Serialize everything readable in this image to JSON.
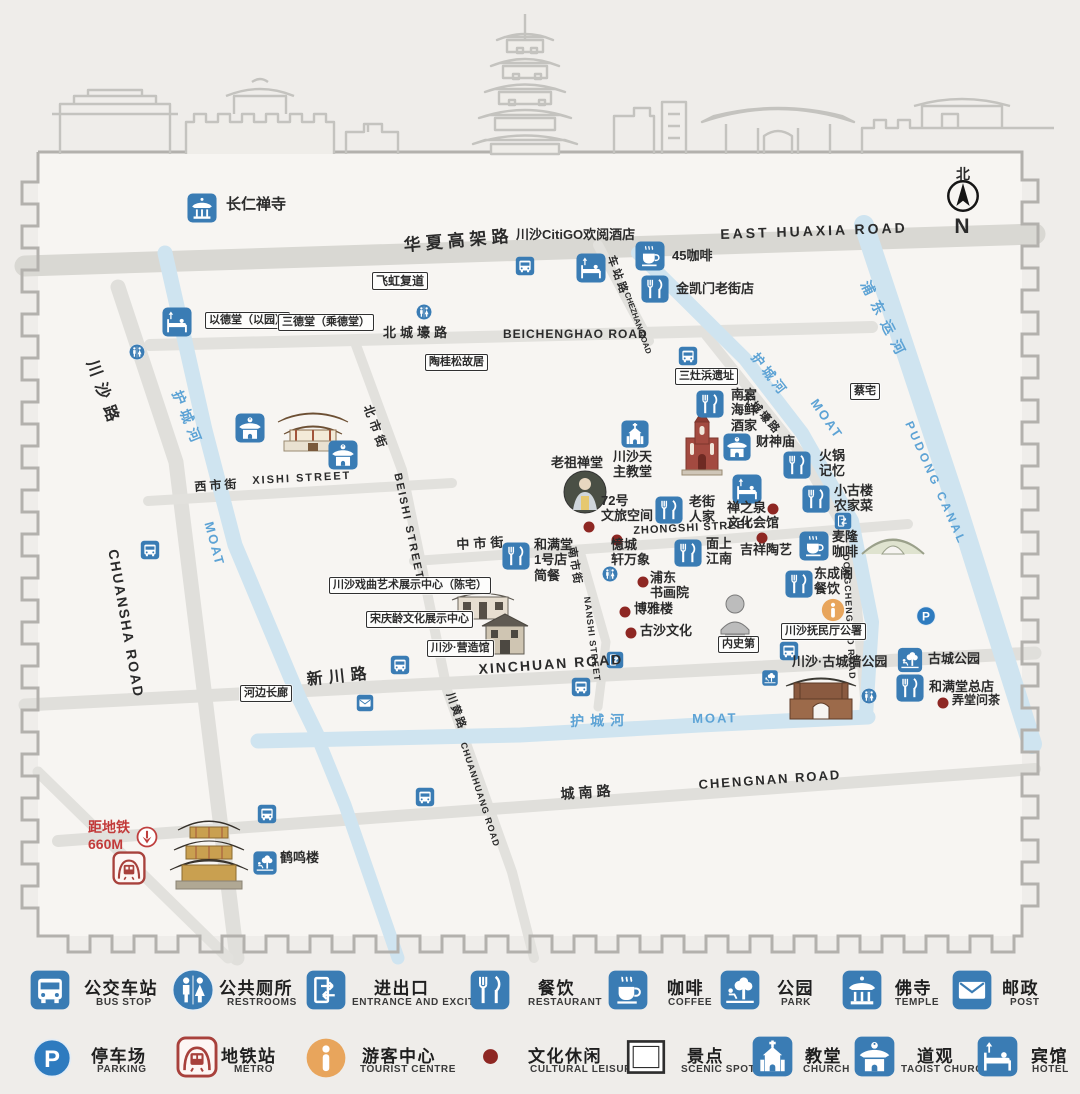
{
  "title": "川沙古镇导览图 Chuansha Old Town tourist map",
  "colors": {
    "icon_blue": "#3a7cb4",
    "metro_red": "#a8413c",
    "tourist_orange": "#e8a55c",
    "river_blue": "#cfe4f0",
    "river_text": "#5da3d5",
    "leisure_dot": "#8e2723",
    "red_text": "#c23a3a",
    "road_gray": "#e2e1dd",
    "ink": "#2b2b2b"
  },
  "north": {
    "zh": "北",
    "en": "N"
  },
  "map": {
    "labels": [
      {
        "t": "华夏高架路",
        "x": 403,
        "y": 236,
        "s": 17,
        "r": -5,
        "k": 5
      },
      {
        "t": "EAST HUAXIA ROAD",
        "x": 720,
        "y": 226,
        "s": 14,
        "r": -2,
        "k": 3
      },
      {
        "t": "北城壕路",
        "x": 383,
        "y": 325,
        "s": 13,
        "k": 4
      },
      {
        "t": "BEICHENGHAO ROAD",
        "x": 503,
        "y": 327,
        "s": 12,
        "k": 1
      },
      {
        "t": "车站路",
        "x": 616,
        "y": 254,
        "s": 11,
        "r": 70,
        "k": 3
      },
      {
        "t": "CHEZHAN ROAD",
        "x": 631,
        "y": 291,
        "s": 8,
        "r": 70
      },
      {
        "t": "川沙路",
        "x": 99,
        "y": 358,
        "s": 16,
        "r": 70,
        "k": 8
      },
      {
        "t": "CHUANSHA ROAD",
        "x": 121,
        "y": 548,
        "s": 14,
        "r": 80,
        "k": 2
      },
      {
        "t": "护城河",
        "x": 184,
        "y": 388,
        "s": 14,
        "r": 68,
        "c": "river",
        "k": 6
      },
      {
        "t": "MOAT",
        "x": 216,
        "y": 520,
        "s": 13,
        "r": 75,
        "c": "river",
        "k": 2
      },
      {
        "t": "西市街",
        "x": 194,
        "y": 480,
        "s": 12,
        "r": -4,
        "k": 3
      },
      {
        "t": "XISHI STREET",
        "x": 252,
        "y": 475,
        "s": 11,
        "r": -3,
        "k": 2
      },
      {
        "t": "北市街",
        "x": 374,
        "y": 403,
        "s": 12,
        "r": 70,
        "k": 4
      },
      {
        "t": "BEISHI STREET",
        "x": 403,
        "y": 472,
        "s": 11,
        "r": 78,
        "k": 2
      },
      {
        "t": "中市街",
        "x": 456,
        "y": 537,
        "s": 13,
        "r": -3,
        "k": 4
      },
      {
        "t": "ZHONGSHI STREET",
        "x": 633,
        "y": 525,
        "s": 11,
        "r": -3,
        "k": 1
      },
      {
        "t": "南市街",
        "x": 577,
        "y": 546,
        "s": 11,
        "r": 80,
        "k": 2
      },
      {
        "t": "NANSHI STREET",
        "x": 592,
        "y": 596,
        "s": 9,
        "r": 83,
        "k": 1
      },
      {
        "t": "东城壕路",
        "x": 748,
        "y": 390,
        "s": 11,
        "r": 48,
        "k": 2
      },
      {
        "t": "DONGCHENGHAO ROAD",
        "x": 851,
        "y": 554,
        "s": 9,
        "r": 87,
        "k": 1
      },
      {
        "t": "新川路",
        "x": 306,
        "y": 672,
        "s": 16,
        "r": -6,
        "k": 6
      },
      {
        "t": "XINCHUAN ROAD",
        "x": 478,
        "y": 661,
        "s": 14,
        "r": -4,
        "k": 2
      },
      {
        "t": "川黄路",
        "x": 455,
        "y": 691,
        "s": 11,
        "r": 70,
        "k": 2
      },
      {
        "t": "CHUANHUANG ROAD",
        "x": 468,
        "y": 741,
        "s": 9,
        "r": 72,
        "k": 1
      },
      {
        "t": "护城河",
        "x": 570,
        "y": 713,
        "s": 14,
        "r": -1,
        "c": "river",
        "k": 6
      },
      {
        "t": "MOAT",
        "x": 692,
        "y": 711,
        "s": 13,
        "r": -1,
        "c": "river",
        "k": 2
      },
      {
        "t": "城南路",
        "x": 560,
        "y": 786,
        "s": 14,
        "r": -4,
        "k": 4
      },
      {
        "t": "CHENGNAN ROAD",
        "x": 698,
        "y": 777,
        "s": 13,
        "r": -4,
        "k": 2
      },
      {
        "t": "浦东运河",
        "x": 872,
        "y": 278,
        "s": 14,
        "r": 63,
        "c": "river",
        "k": 8
      },
      {
        "t": "PUDONG CANAL",
        "x": 915,
        "y": 419,
        "s": 12,
        "r": 66,
        "c": "river",
        "k": 3
      },
      {
        "t": "护城河",
        "x": 760,
        "y": 350,
        "s": 13,
        "r": 52,
        "c": "river",
        "k": 4
      },
      {
        "t": "MOAT",
        "x": 820,
        "y": 396,
        "s": 13,
        "r": 55,
        "c": "river",
        "k": 2
      },
      {
        "t": "长仁禅寺",
        "x": 226,
        "y": 196,
        "s": 15
      },
      {
        "t": "川沙CitiGO欢阅酒店",
        "x": 516,
        "y": 227,
        "s": 13
      },
      {
        "t": "45咖啡",
        "x": 672,
        "y": 248,
        "s": 13
      },
      {
        "t": "金凯门老街店",
        "x": 676,
        "y": 281,
        "s": 13
      },
      {
        "t": "飞虹复道",
        "x": 372,
        "y": 272,
        "s": 12,
        "b": true
      },
      {
        "t": "以德堂（以园）",
        "x": 205,
        "y": 312,
        "s": 11,
        "b": true
      },
      {
        "t": "三德堂（乘德堂）",
        "x": 278,
        "y": 314,
        "s": 11,
        "b": true
      },
      {
        "t": "陶桂松故居",
        "x": 425,
        "y": 354,
        "s": 11,
        "b": true
      },
      {
        "t": "三灶浜遗址",
        "x": 675,
        "y": 368,
        "s": 11,
        "b": true
      },
      {
        "t": "蔡宅",
        "x": 850,
        "y": 383,
        "s": 11,
        "b": true
      },
      {
        "t": "南宫\n海鲜\n酒家",
        "x": 731,
        "y": 387,
        "s": 13
      },
      {
        "t": "财神庙",
        "x": 756,
        "y": 434,
        "s": 13
      },
      {
        "t": "川沙天\n主教堂",
        "x": 613,
        "y": 449,
        "s": 13
      },
      {
        "t": "老祖禅堂",
        "x": 551,
        "y": 455,
        "s": 13
      },
      {
        "t": "72号\n文旅空间",
        "x": 601,
        "y": 493,
        "s": 13
      },
      {
        "t": "老街\n人家",
        "x": 689,
        "y": 494,
        "s": 13
      },
      {
        "t": "禅之泉\n文化会馆",
        "x": 727,
        "y": 500,
        "s": 13
      },
      {
        "t": "火锅\n记忆",
        "x": 819,
        "y": 448,
        "s": 13
      },
      {
        "t": "小古楼\n农家菜",
        "x": 834,
        "y": 483,
        "s": 13
      },
      {
        "t": "麦隆\n咖啡",
        "x": 832,
        "y": 529,
        "s": 13
      },
      {
        "t": "吉祥陶艺",
        "x": 740,
        "y": 542,
        "s": 13
      },
      {
        "t": "面上\n江南",
        "x": 706,
        "y": 536,
        "s": 13
      },
      {
        "t": "和满堂\n1号店\n简餐",
        "x": 534,
        "y": 537,
        "s": 13
      },
      {
        "t": "憶城\n轩万象",
        "x": 611,
        "y": 537,
        "s": 13
      },
      {
        "t": "浦东\n书画院",
        "x": 650,
        "y": 570,
        "s": 13
      },
      {
        "t": "博雅楼",
        "x": 634,
        "y": 601,
        "s": 13
      },
      {
        "t": "古沙文化",
        "x": 640,
        "y": 623,
        "s": 13
      },
      {
        "t": "东成阁\n餐饮",
        "x": 814,
        "y": 566,
        "s": 13
      },
      {
        "t": "川沙戏曲艺术展示中心（陈宅）",
        "x": 329,
        "y": 577,
        "s": 11,
        "b": true
      },
      {
        "t": "宋庆龄文化展示中心",
        "x": 366,
        "y": 611,
        "s": 11,
        "b": true
      },
      {
        "t": "川沙·营造馆",
        "x": 427,
        "y": 640,
        "s": 11,
        "b": true
      },
      {
        "t": "内史第",
        "x": 718,
        "y": 636,
        "s": 11,
        "b": true
      },
      {
        "t": "川沙抚民厅公署",
        "x": 781,
        "y": 623,
        "s": 11,
        "b": true
      },
      {
        "t": "川沙·古城墙公园",
        "x": 792,
        "y": 654,
        "s": 13
      },
      {
        "t": "古城公园",
        "x": 928,
        "y": 651,
        "s": 13
      },
      {
        "t": "和满堂总店",
        "x": 929,
        "y": 679,
        "s": 13
      },
      {
        "t": "弄堂问茶",
        "x": 952,
        "y": 693,
        "s": 12
      },
      {
        "t": "河边长廊",
        "x": 240,
        "y": 685,
        "s": 11,
        "b": true
      },
      {
        "t": "鹤鸣楼",
        "x": 280,
        "y": 850,
        "s": 13
      },
      {
        "t": "距地铁\n660M",
        "x": 88,
        "y": 819,
        "s": 14,
        "c": "red"
      },
      {
        "t": "北",
        "x": 963,
        "y": 166,
        "s": 14,
        "a": "c"
      },
      {
        "t": "N",
        "x": 962,
        "y": 215,
        "s": 21,
        "a": "c"
      }
    ],
    "icons": [
      {
        "t": "temple",
        "x": 202,
        "y": 208
      },
      {
        "t": "hotel",
        "x": 177,
        "y": 322
      },
      {
        "t": "hotel",
        "x": 591,
        "y": 268
      },
      {
        "t": "hotel",
        "x": 747,
        "y": 489
      },
      {
        "t": "bus",
        "x": 525,
        "y": 266
      },
      {
        "t": "bus",
        "x": 688,
        "y": 356
      },
      {
        "t": "bus",
        "x": 150,
        "y": 550
      },
      {
        "t": "bus",
        "x": 400,
        "y": 665
      },
      {
        "t": "bus",
        "x": 581,
        "y": 687
      },
      {
        "t": "bus",
        "x": 789,
        "y": 651
      },
      {
        "t": "bus",
        "x": 267,
        "y": 814
      },
      {
        "t": "bus",
        "x": 425,
        "y": 797
      },
      {
        "t": "coffee",
        "x": 650,
        "y": 256
      },
      {
        "t": "coffee",
        "x": 814,
        "y": 546
      },
      {
        "t": "restaurant",
        "x": 655,
        "y": 289
      },
      {
        "t": "restaurant",
        "x": 710,
        "y": 404
      },
      {
        "t": "restaurant",
        "x": 797,
        "y": 465
      },
      {
        "t": "restaurant",
        "x": 816,
        "y": 499
      },
      {
        "t": "restaurant",
        "x": 669,
        "y": 510
      },
      {
        "t": "restaurant",
        "x": 516,
        "y": 556
      },
      {
        "t": "restaurant",
        "x": 688,
        "y": 553
      },
      {
        "t": "restaurant",
        "x": 799,
        "y": 584
      },
      {
        "t": "restaurant",
        "x": 910,
        "y": 688
      },
      {
        "t": "church",
        "x": 635,
        "y": 434
      },
      {
        "t": "taoist",
        "x": 250,
        "y": 428
      },
      {
        "t": "taoist",
        "x": 343,
        "y": 455
      },
      {
        "t": "taoist",
        "x": 737,
        "y": 447,
        "s": 28
      },
      {
        "t": "restroom",
        "x": 137,
        "y": 352
      },
      {
        "t": "restroom",
        "x": 424,
        "y": 312
      },
      {
        "t": "restroom",
        "x": 610,
        "y": 574
      },
      {
        "t": "restroom",
        "x": 869,
        "y": 696
      },
      {
        "t": "entrance",
        "x": 615,
        "y": 660
      },
      {
        "t": "entrance",
        "x": 843,
        "y": 521
      },
      {
        "t": "park",
        "x": 910,
        "y": 660
      },
      {
        "t": "park",
        "x": 770,
        "y": 678,
        "s": 16
      },
      {
        "t": "park",
        "x": 265,
        "y": 863,
        "s": 24
      },
      {
        "t": "post",
        "x": 365,
        "y": 703
      },
      {
        "t": "parking",
        "x": 926,
        "y": 616
      },
      {
        "t": "tourist",
        "x": 833,
        "y": 610
      },
      {
        "t": "metro",
        "x": 129,
        "y": 868
      },
      {
        "t": "reddown",
        "x": 147,
        "y": 837
      },
      {
        "t": "compass",
        "x": 963,
        "y": 196,
        "s": 38
      }
    ],
    "dots": [
      {
        "x": 589,
        "y": 527
      },
      {
        "x": 617,
        "y": 540
      },
      {
        "x": 643,
        "y": 582
      },
      {
        "x": 625,
        "y": 612
      },
      {
        "x": 631,
        "y": 633
      },
      {
        "x": 762,
        "y": 538
      },
      {
        "x": 773,
        "y": 509
      },
      {
        "x": 943,
        "y": 703
      }
    ]
  },
  "legend": {
    "items": [
      {
        "t": "bus",
        "zh": "公交车站",
        "en": "BUS STOP",
        "ix": 30,
        "iy": 970,
        "is": 40,
        "zx": 84,
        "zy": 974,
        "ex": 96,
        "ey": 997
      },
      {
        "t": "restroom",
        "zh": "公共厕所",
        "en": "RESTROOMS",
        "ix": 172,
        "iy": 969,
        "is": 42,
        "zx": 219,
        "zy": 974,
        "ex": 227,
        "ey": 997
      },
      {
        "t": "entrance",
        "zh": "进出口",
        "en": "ENTRANCE AND EXCIT",
        "ix": 306,
        "iy": 970,
        "is": 40,
        "zx": 374,
        "zy": 974,
        "ex": 352,
        "ey": 997
      },
      {
        "t": "restaurant",
        "zh": "餐饮",
        "en": "RESTAURANT",
        "ix": 470,
        "iy": 970,
        "is": 40,
        "zx": 538,
        "zy": 974,
        "ex": 528,
        "ey": 997
      },
      {
        "t": "coffee",
        "zh": "咖啡",
        "en": "COFFEE",
        "ix": 608,
        "iy": 970,
        "is": 40,
        "zx": 667,
        "zy": 974,
        "ex": 668,
        "ey": 997
      },
      {
        "t": "park",
        "zh": "公园",
        "en": "PARK",
        "ix": 720,
        "iy": 970,
        "is": 40,
        "zx": 777,
        "zy": 974,
        "ex": 781,
        "ey": 997
      },
      {
        "t": "temple",
        "zh": "佛寺",
        "en": "TEMPLE",
        "ix": 842,
        "iy": 970,
        "is": 40,
        "zx": 895,
        "zy": 974,
        "ex": 895,
        "ey": 997
      },
      {
        "t": "post",
        "zh": "邮政",
        "en": "POST",
        "ix": 952,
        "iy": 970,
        "is": 40,
        "zx": 1002,
        "zy": 974,
        "ex": 1010,
        "ey": 997
      },
      {
        "t": "parking",
        "zh": "停车场",
        "en": "PARKING",
        "ix": 32,
        "iy": 1038,
        "is": 40,
        "zx": 91,
        "zy": 1042,
        "ex": 97,
        "ey": 1064
      },
      {
        "t": "metro",
        "zh": "地铁站",
        "en": "METRO",
        "ix": 176,
        "iy": 1036,
        "is": 42,
        "zx": 221,
        "zy": 1042,
        "ex": 234,
        "ey": 1064
      },
      {
        "t": "tourist",
        "zh": "游客中心",
        "en": "TOURIST CENTRE",
        "ix": 306,
        "iy": 1038,
        "is": 40,
        "zx": 362,
        "zy": 1042,
        "ex": 360,
        "ey": 1064
      },
      {
        "t": "dot",
        "zh": "文化休闲",
        "en": "CULTURAL LEISURE",
        "ix": 482,
        "iy": 1048,
        "is": 17,
        "zx": 528,
        "zy": 1042,
        "ex": 530,
        "ey": 1064
      },
      {
        "t": "scenic",
        "zh": "景点",
        "en": "SCENIC SPOT",
        "ix": 626,
        "iy": 1037,
        "is": 40,
        "zx": 687,
        "zy": 1042,
        "ex": 681,
        "ey": 1064
      },
      {
        "t": "church",
        "zh": "教堂",
        "en": "CHURCH",
        "ix": 752,
        "iy": 1036,
        "is": 41,
        "zx": 805,
        "zy": 1042,
        "ex": 803,
        "ey": 1064
      },
      {
        "t": "taoist",
        "zh": "道观",
        "en": "TAOIST CHURCH",
        "ix": 854,
        "iy": 1036,
        "is": 41,
        "zx": 917,
        "zy": 1042,
        "ex": 901,
        "ey": 1064
      },
      {
        "t": "hotel",
        "zh": "宾馆",
        "en": "HOTEL",
        "ix": 977,
        "iy": 1036,
        "is": 41,
        "zx": 1031,
        "zy": 1042,
        "ex": 1032,
        "ey": 1064
      }
    ]
  }
}
